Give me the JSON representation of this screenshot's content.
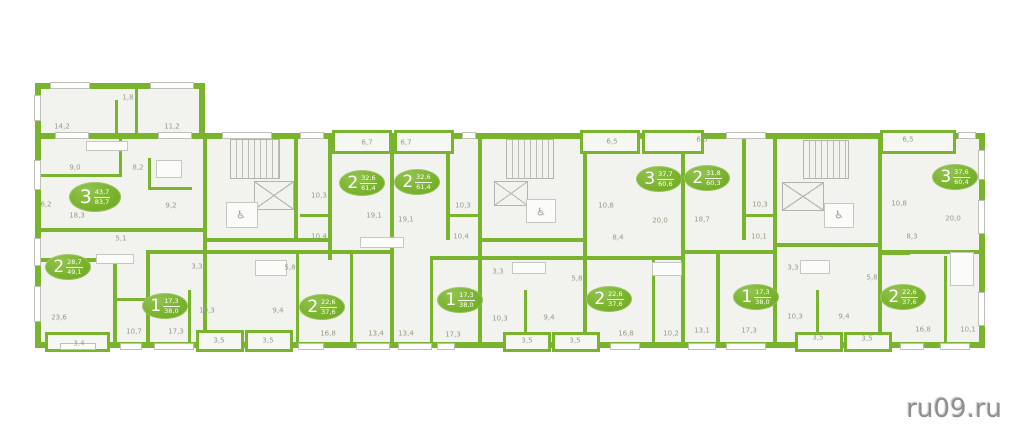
{
  "watermark": "ru09.ru",
  "icons": {
    "wheelchair": "♿"
  },
  "colors": {
    "wall_green": "#7ab32e",
    "badge_green": "#7ab32e",
    "label_olive": "#949d85",
    "floor_fill": "#f2f2ee",
    "watermark_gray": "#8f8f8f"
  },
  "plan": {
    "units": [
      {
        "rooms": "3",
        "living": "43,7",
        "total": "83,7",
        "x": 95,
        "y": 197,
        "big": true
      },
      {
        "rooms": "2",
        "living": "28,7",
        "total": "49,1",
        "x": 68,
        "y": 267,
        "big": false
      },
      {
        "rooms": "1",
        "living": "17,3",
        "total": "38,0",
        "x": 165,
        "y": 306,
        "big": false
      },
      {
        "rooms": "2",
        "living": "32,6",
        "total": "61,4",
        "x": 362,
        "y": 183,
        "big": false
      },
      {
        "rooms": "2",
        "living": "32,6",
        "total": "61,4",
        "x": 417,
        "y": 182,
        "big": false
      },
      {
        "rooms": "2",
        "living": "22,6",
        "total": "37,6",
        "x": 322,
        "y": 307,
        "big": false
      },
      {
        "rooms": "1",
        "living": "17,3",
        "total": "38,0",
        "x": 460,
        "y": 300,
        "big": false
      },
      {
        "rooms": "2",
        "living": "22,6",
        "total": "37,6",
        "x": 609,
        "y": 299,
        "big": false
      },
      {
        "rooms": "3",
        "living": "37,7",
        "total": "60,6",
        "x": 659,
        "y": 179,
        "big": false
      },
      {
        "rooms": "2",
        "living": "31,8",
        "total": "60,3",
        "x": 707,
        "y": 178,
        "big": false
      },
      {
        "rooms": "1",
        "living": "17,3",
        "total": "38,0",
        "x": 756,
        "y": 297,
        "big": false
      },
      {
        "rooms": "2",
        "living": "22,6",
        "total": "37,6",
        "x": 903,
        "y": 297,
        "big": false
      },
      {
        "rooms": "3",
        "living": "37,6",
        "total": "60,4",
        "x": 955,
        "y": 177,
        "big": false
      }
    ],
    "rooms": [
      {
        "label": "1,8",
        "x": 128,
        "y": 98
      },
      {
        "label": "14,2",
        "x": 62,
        "y": 127
      },
      {
        "label": "11,2",
        "x": 172,
        "y": 127
      },
      {
        "label": "9,0",
        "x": 75,
        "y": 168
      },
      {
        "label": "8,2",
        "x": 138,
        "y": 168
      },
      {
        "label": "6,2",
        "x": 46,
        "y": 205
      },
      {
        "label": "18,3",
        "x": 77,
        "y": 216
      },
      {
        "label": "9,2",
        "x": 171,
        "y": 206
      },
      {
        "label": "5,1",
        "x": 121,
        "y": 239
      },
      {
        "label": "23,6",
        "x": 59,
        "y": 318
      },
      {
        "label": "3,4",
        "x": 79,
        "y": 344
      },
      {
        "label": "10,7",
        "x": 134,
        "y": 332
      },
      {
        "label": "17,3",
        "x": 176,
        "y": 332
      },
      {
        "label": "3,3",
        "x": 197,
        "y": 267
      },
      {
        "label": "10,3",
        "x": 207,
        "y": 311
      },
      {
        "label": "3,5",
        "x": 219,
        "y": 341
      },
      {
        "label": "3,5",
        "x": 268,
        "y": 341
      },
      {
        "label": "9,4",
        "x": 278,
        "y": 311
      },
      {
        "label": "5,8",
        "x": 290,
        "y": 268
      },
      {
        "label": "10,3",
        "x": 319,
        "y": 196
      },
      {
        "label": "10,4",
        "x": 319,
        "y": 237
      },
      {
        "label": "6,7",
        "x": 367,
        "y": 143
      },
      {
        "label": "6,7",
        "x": 406,
        "y": 143
      },
      {
        "label": "19,1",
        "x": 374,
        "y": 216
      },
      {
        "label": "19,1",
        "x": 406,
        "y": 220
      },
      {
        "label": "10,3",
        "x": 463,
        "y": 206
      },
      {
        "label": "10,4",
        "x": 461,
        "y": 237
      },
      {
        "label": "16,8",
        "x": 328,
        "y": 334
      },
      {
        "label": "13,4",
        "x": 376,
        "y": 334
      },
      {
        "label": "13,4",
        "x": 406,
        "y": 334
      },
      {
        "label": "17,3",
        "x": 453,
        "y": 335
      },
      {
        "label": "3,3",
        "x": 498,
        "y": 272
      },
      {
        "label": "5,8",
        "x": 577,
        "y": 279
      },
      {
        "label": "10,3",
        "x": 500,
        "y": 319
      },
      {
        "label": "9,4",
        "x": 549,
        "y": 318
      },
      {
        "label": "3,5",
        "x": 527,
        "y": 341
      },
      {
        "label": "3,5",
        "x": 575,
        "y": 341
      },
      {
        "label": "16,8",
        "x": 626,
        "y": 334
      },
      {
        "label": "6,5",
        "x": 612,
        "y": 142
      },
      {
        "label": "6,5",
        "x": 702,
        "y": 140
      },
      {
        "label": "10,8",
        "x": 606,
        "y": 206
      },
      {
        "label": "20,0",
        "x": 660,
        "y": 221
      },
      {
        "label": "18,7",
        "x": 702,
        "y": 220
      },
      {
        "label": "8,4",
        "x": 618,
        "y": 238
      },
      {
        "label": "10,2",
        "x": 671,
        "y": 334
      },
      {
        "label": "13,1",
        "x": 702,
        "y": 331
      },
      {
        "label": "17,3",
        "x": 749,
        "y": 331
      },
      {
        "label": "10,3",
        "x": 760,
        "y": 205
      },
      {
        "label": "10,1",
        "x": 759,
        "y": 237
      },
      {
        "label": "3,3",
        "x": 793,
        "y": 268
      },
      {
        "label": "10,3",
        "x": 795,
        "y": 317
      },
      {
        "label": "5,8",
        "x": 872,
        "y": 278
      },
      {
        "label": "9,4",
        "x": 844,
        "y": 317
      },
      {
        "label": "3,5",
        "x": 818,
        "y": 338
      },
      {
        "label": "3,5",
        "x": 867,
        "y": 339
      },
      {
        "label": "16,8",
        "x": 923,
        "y": 330
      },
      {
        "label": "10,1",
        "x": 968,
        "y": 330
      },
      {
        "label": "6,5",
        "x": 908,
        "y": 140
      },
      {
        "label": "10,8",
        "x": 899,
        "y": 204
      },
      {
        "label": "20,0",
        "x": 953,
        "y": 219
      },
      {
        "label": "8,3",
        "x": 912,
        "y": 237
      }
    ],
    "wheelchair_spots": [
      {
        "x": 241,
        "y": 215
      },
      {
        "x": 541,
        "y": 212
      },
      {
        "x": 839,
        "y": 215
      }
    ]
  }
}
